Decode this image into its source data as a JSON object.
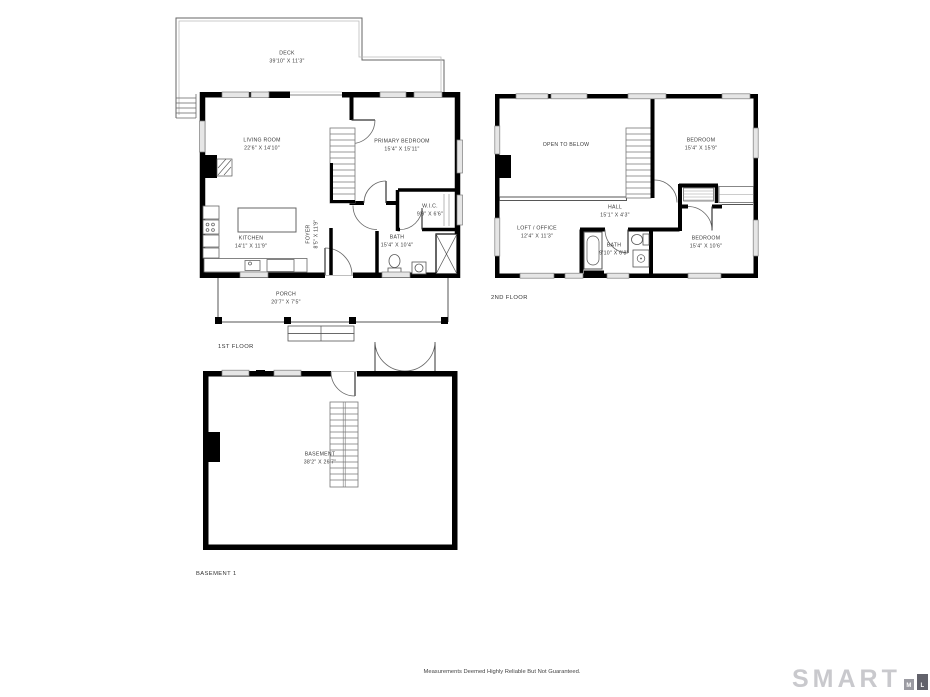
{
  "floors": {
    "first": {
      "title": "1ST FLOOR",
      "rooms": {
        "deck": {
          "name": "DECK",
          "dims": "39'10\" X 11'3\""
        },
        "living_room": {
          "name": "LIVING ROOM",
          "dims": "22'6\" X 14'10\""
        },
        "primary_bedroom": {
          "name": "PRIMARY BEDROOM",
          "dims": "15'4\" X 15'11\""
        },
        "wic": {
          "name": "W.I.C.",
          "dims": "9'9\" X 6'6\""
        },
        "bath": {
          "name": "BATH",
          "dims": "15'4\" X 10'4\""
        },
        "kitchen": {
          "name": "KITCHEN",
          "dims": "14'1\" X 11'9\""
        },
        "foyer": {
          "name": "FOYER",
          "dims": "8'5\" X 11'9\""
        },
        "porch": {
          "name": "PORCH",
          "dims": "20'7\" X 7'5\""
        }
      }
    },
    "second": {
      "title": "2ND FLOOR",
      "rooms": {
        "open_to_below": {
          "name": "OPEN TO BELOW",
          "dims": ""
        },
        "bedroom_top": {
          "name": "BEDROOM",
          "dims": "15'4\" X 15'9\""
        },
        "hall": {
          "name": "HALL",
          "dims": "15'1\" X 4'3\""
        },
        "loft_office": {
          "name": "LOFT / OFFICE",
          "dims": "12'4\" X 11'3\""
        },
        "bath": {
          "name": "BATH",
          "dims": "9'10\" X 6'8\""
        },
        "bedroom_bottom": {
          "name": "BEDROOM",
          "dims": "15'4\" X 10'6\""
        }
      }
    },
    "basement": {
      "title": "BASEMENT 1",
      "rooms": {
        "basement": {
          "name": "BASEMENT",
          "dims": "38'2\" X 26'7\""
        }
      }
    }
  },
  "footer": {
    "disclaimer": "Measurements Deemed Highly Reliable But Not Guaranteed."
  },
  "logo": {
    "brand": "SMART",
    "mls": [
      "M",
      "L",
      "S"
    ]
  },
  "colors": {
    "wall": "#000000",
    "window_fill": "#e6e6e6",
    "thin_line": "#666666",
    "label_text": "#3a3a3a",
    "logo_gray": "#c9c9cd",
    "logo_block_m": "#9b9ba2",
    "logo_block_l": "#62626b",
    "logo_block_s": "#34343f"
  }
}
